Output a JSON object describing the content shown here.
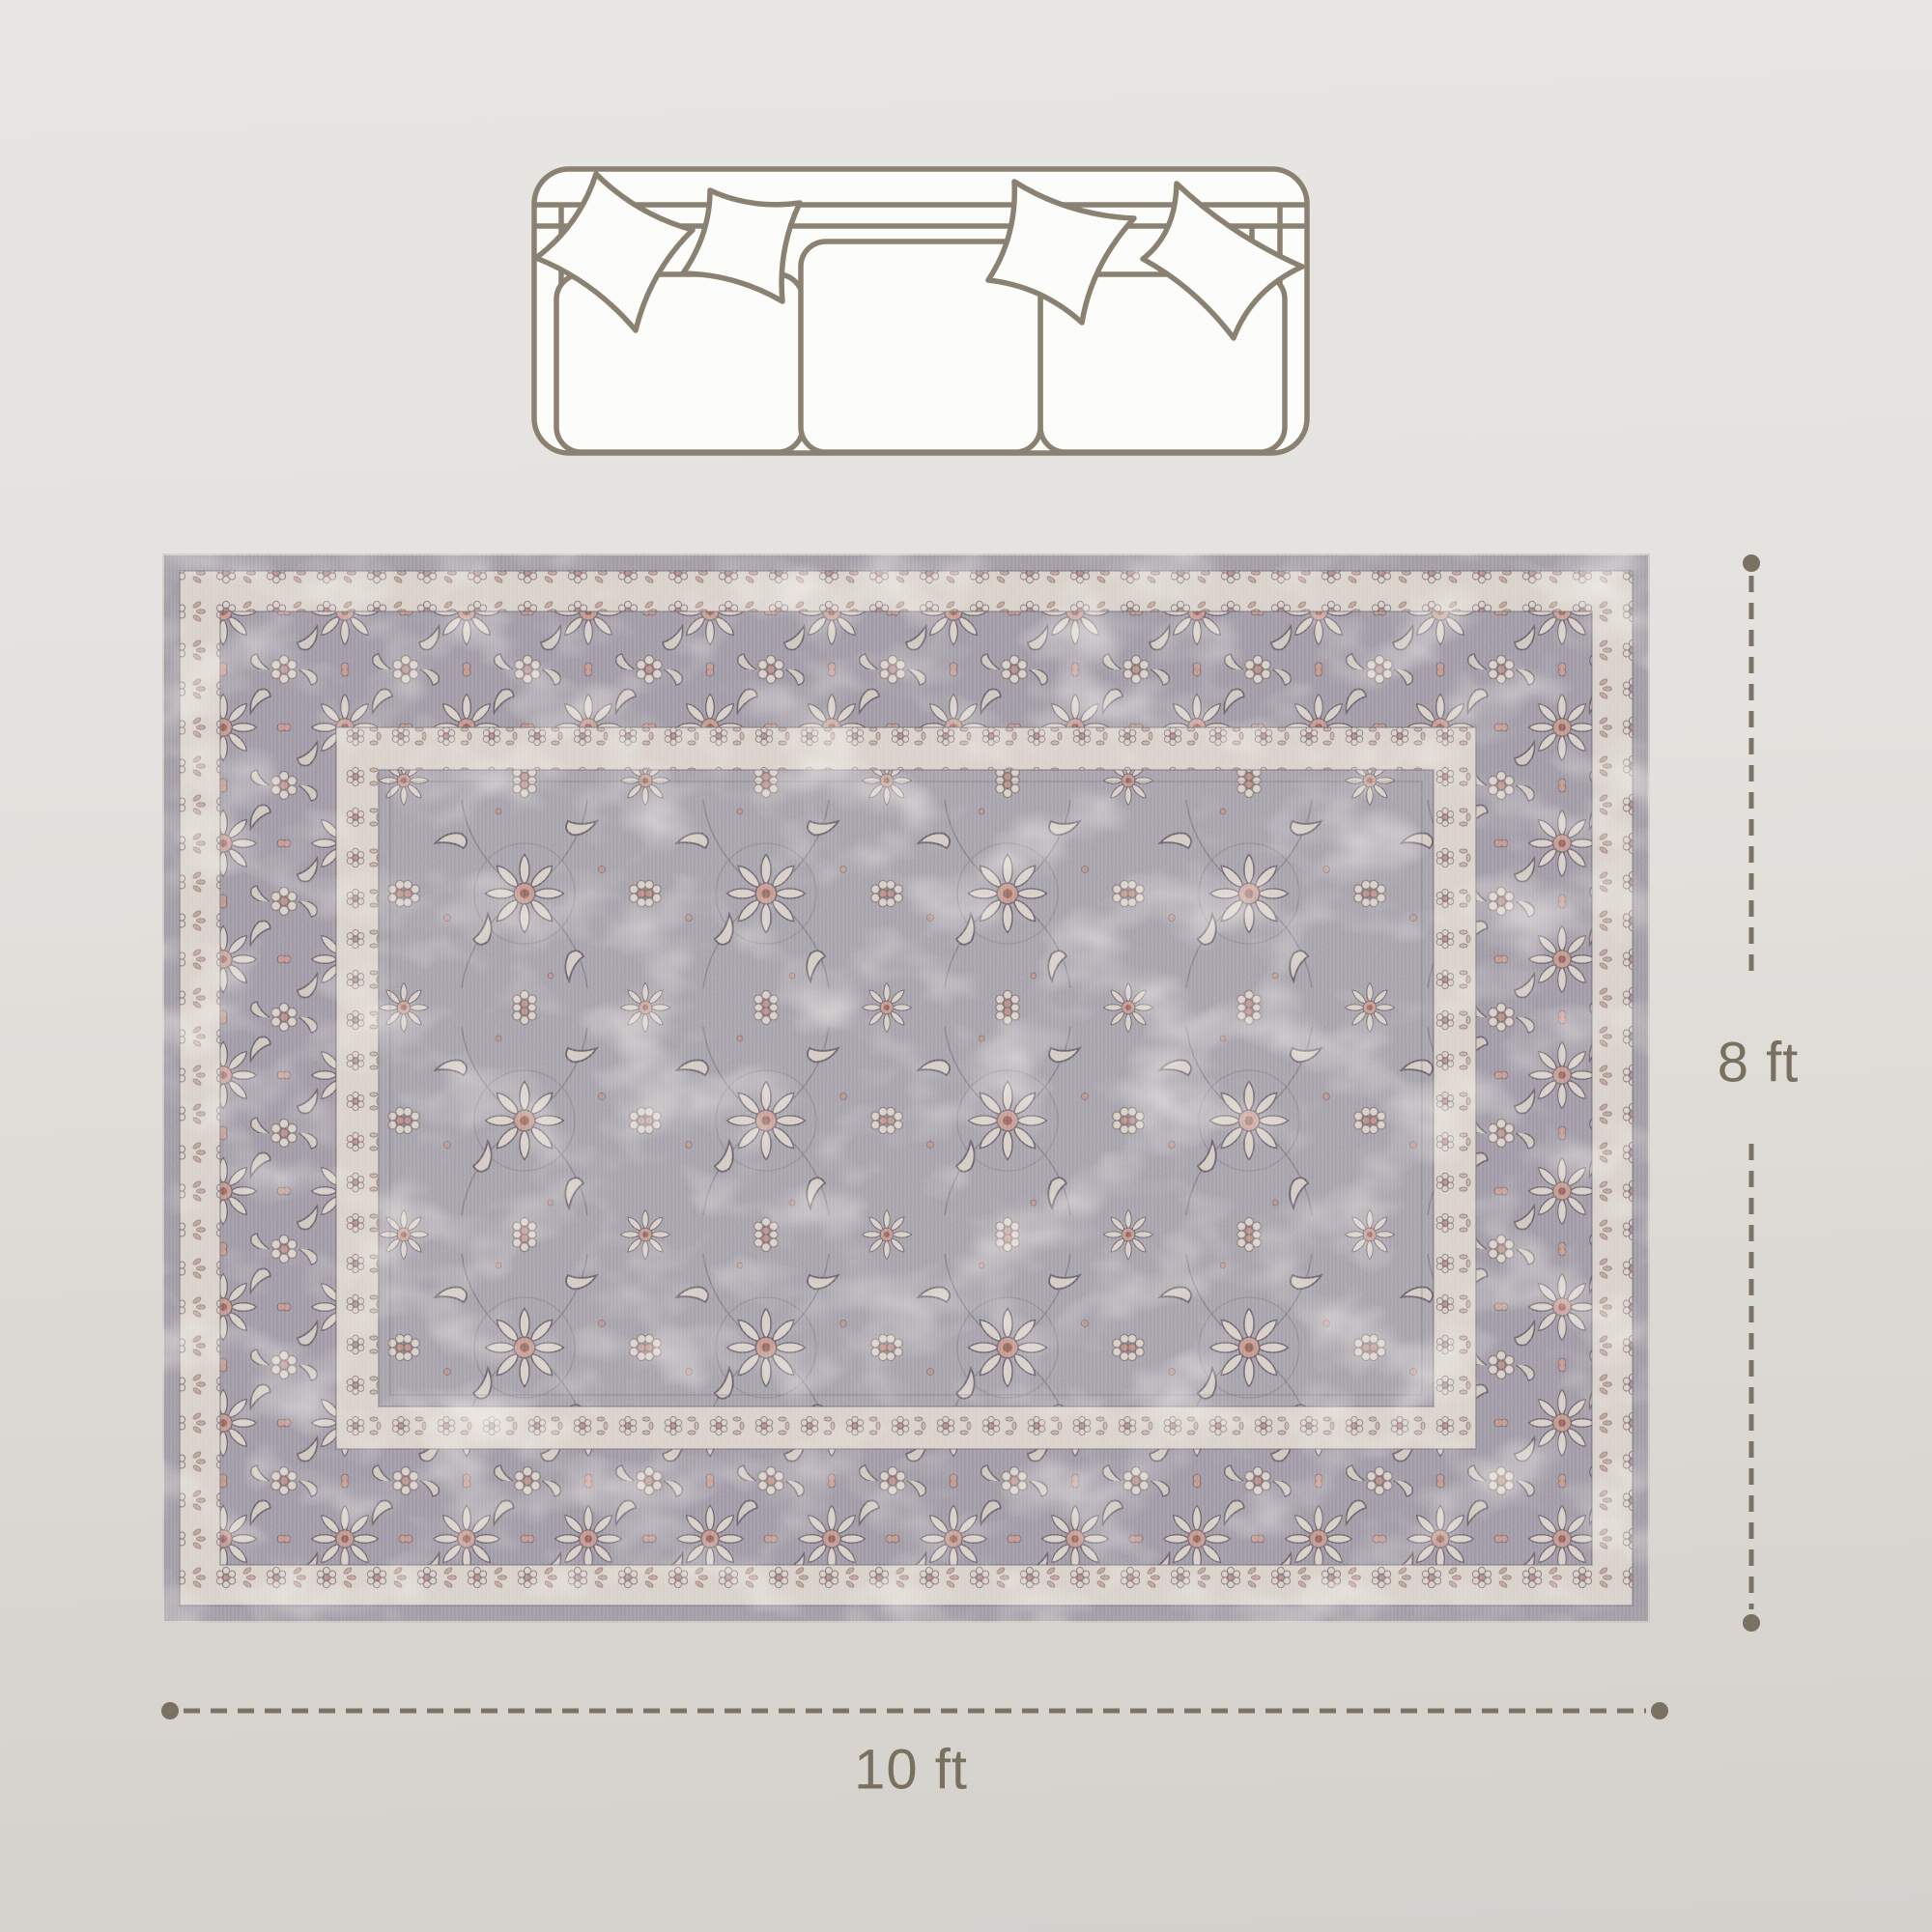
{
  "figure": {
    "kind": "rug-size-diagram"
  },
  "dimension_labels": {
    "width": "10 ft",
    "height": "8 ft"
  },
  "icons": {
    "sofa": "sofa-top-view-icon",
    "rug": "vintage-floral-area-rug"
  },
  "colors": {
    "background_top": "#e8e6e2",
    "background_bottom": "#d4d1cd",
    "dimension_line": "#7c7365",
    "dimension_dot": "#7a7163",
    "label_text": "#79705f",
    "sofa_outline": "#8b8172",
    "sofa_fill": "#fcfcfa",
    "rug_field_gray": "#a7a3ac",
    "rug_border_gray": "#a09ba6",
    "rug_cream": "#d9d2cb",
    "rug_rose": "#bd9189",
    "rug_dark_outline": "#6f6570"
  }
}
